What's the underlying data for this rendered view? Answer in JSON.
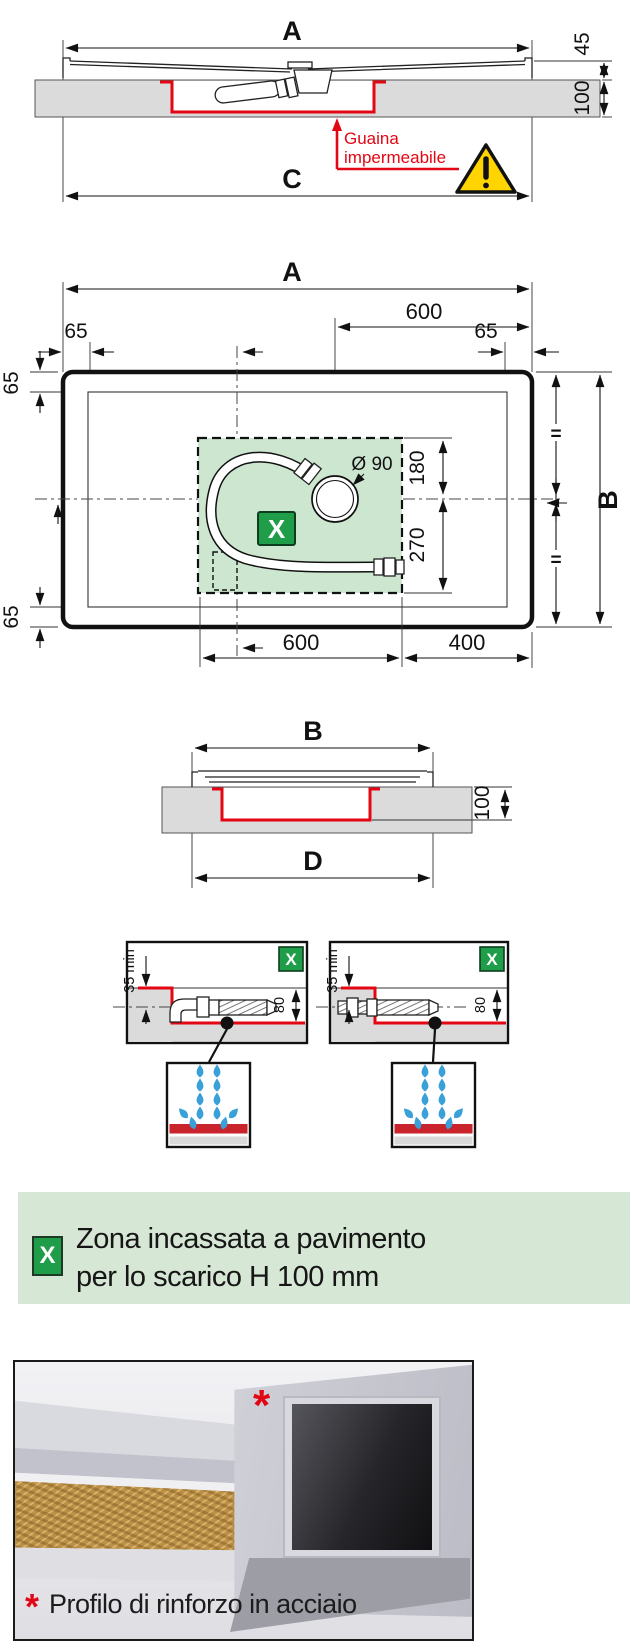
{
  "cross_section_top": {
    "dim_width_top": "A",
    "dim_tray_height": "45",
    "dim_recess_depth": "100",
    "membrane_label_line1": "Guaina",
    "membrane_label_line2": "impermeabile",
    "dim_width_bottom": "C"
  },
  "plan_view": {
    "dim_width": "A",
    "dim_drain_from_right": "600",
    "dim_edge": "65",
    "drain_diameter_label": "Ø 90",
    "dim_zone_above_axis": "180",
    "dim_zone_below_axis": "270",
    "equal_mark": "=",
    "dim_depth": "B",
    "dim_zone_width": "600",
    "dim_zone_to_edge": "400",
    "zone_marker": "X"
  },
  "cross_section_b": {
    "dim_width_top": "B",
    "dim_recess_depth": "100",
    "dim_width_bottom": "D"
  },
  "drain_details": {
    "dim_min_cover": "35 min",
    "dim_trench_depth": "80",
    "zone_marker": "X"
  },
  "legend": {
    "marker": "X",
    "text_line1": "Zona incassata a pavimento",
    "text_line2": "per lo scarico H 100 mm"
  },
  "photo": {
    "marker_asterisk": "*",
    "caption": "Profilo di rinforzo in acciaio"
  },
  "icons": {
    "warning": "warning-triangle-icon",
    "zone_marker": "x-marker-icon",
    "water": "water-drops-icon"
  },
  "colors": {
    "red": "#e30613",
    "zone_green": "#cde6d0",
    "marker_green": "#1f9d49",
    "banner_green": "#d7e7d5",
    "warning_yellow": "#ffd400",
    "floor_grey": "#dbdbdb",
    "water_blue": "#39a0d8"
  }
}
